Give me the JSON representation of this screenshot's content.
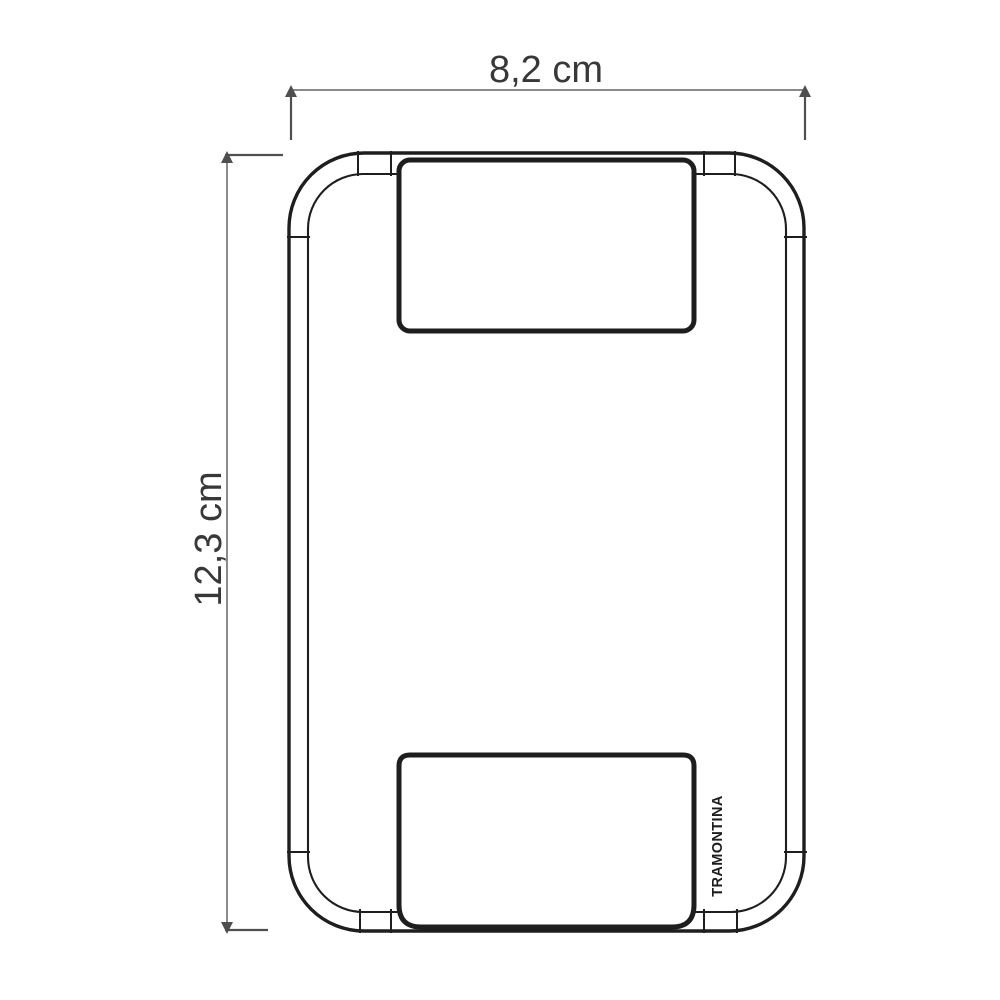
{
  "diagram": {
    "dimension_width": {
      "label": "8,2 cm"
    },
    "dimension_height": {
      "label": "12,3 cm"
    },
    "brand_mark": "TRAMONTINA",
    "colors": {
      "background": "#ffffff",
      "outline": "#1e1e1e",
      "dimension_line": "#8a8a8a",
      "dimension_ext": "#4f4f4f",
      "label_text": "#383838"
    }
  }
}
